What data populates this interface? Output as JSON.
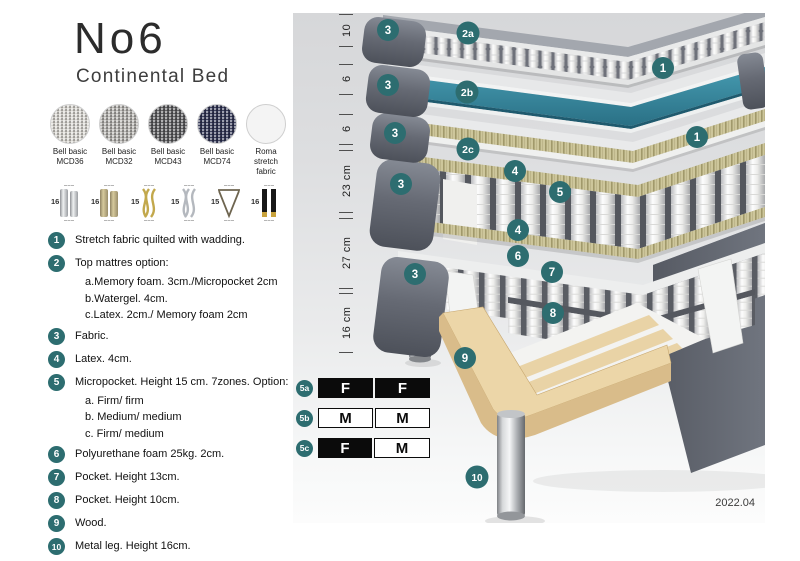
{
  "header": {
    "title": "No6",
    "subtitle": "Continental Bed"
  },
  "fabrics": [
    {
      "line1": "Bell basic",
      "line2": "MCD36"
    },
    {
      "line1": "Bell basic",
      "line2": "MCD32"
    },
    {
      "line1": "Bell basic",
      "line2": "MCD43"
    },
    {
      "line1": "Bell basic",
      "line2": "MCD74"
    },
    {
      "line1": "Roma",
      "line2": "stretch fabric"
    }
  ],
  "legs": [
    {
      "size": "16",
      "type": "cylinder-chrome"
    },
    {
      "size": "16",
      "type": "cylinder-brass"
    },
    {
      "size": "15",
      "type": "twisted-gold"
    },
    {
      "size": "15",
      "type": "twisted-silver"
    },
    {
      "size": "15",
      "type": "hairpin"
    },
    {
      "size": "16",
      "type": "black-gold"
    }
  ],
  "legend": [
    {
      "num": "1",
      "text": "Stretch fabric quilted with wadding."
    },
    {
      "num": "2",
      "text": "Top mattres option:",
      "sub": [
        "a.Memory foam. 3cm./Micropocket 2cm",
        "b.Watergel. 4cm.",
        "c.Latex. 2cm./ Memory foam 2cm"
      ]
    },
    {
      "num": "3",
      "text": "Fabric."
    },
    {
      "num": "4",
      "text": "Latex. 4cm."
    },
    {
      "num": "5",
      "text": "Micropocket. Height 15 cm. 7zones. Option:",
      "sub": [
        "a. Firm/ firm",
        "b. Medium/ medium",
        "c. Firm/ medium"
      ]
    },
    {
      "num": "6",
      "text": "Polyurethane foam 25kg. 2cm."
    },
    {
      "num": "7",
      "text": "Pocket. Height 13cm."
    },
    {
      "num": "8",
      "text": "Pocket. Height 10cm."
    },
    {
      "num": "9",
      "text": "Wood."
    },
    {
      "num": "10",
      "text": "Metal leg. Height 16cm."
    }
  ],
  "ruler": [
    "10",
    "6",
    "6",
    "23 cm",
    "27 cm",
    "16 cm"
  ],
  "badges": {
    "b1": "1",
    "b2a": "2a",
    "b2b": "2b",
    "b2c": "2c",
    "b3": "3",
    "b4": "4",
    "b5": "5",
    "b6": "6",
    "b7": "7",
    "b8": "8",
    "b9": "9",
    "b10": "10"
  },
  "firmness": [
    {
      "id": "5a",
      "cells": [
        {
          "label": "F",
          "style": "dark"
        },
        {
          "label": "F",
          "style": "dark"
        }
      ]
    },
    {
      "id": "5b",
      "cells": [
        {
          "label": "M",
          "style": "light"
        },
        {
          "label": "M",
          "style": "light"
        }
      ]
    },
    {
      "id": "5c",
      "cells": [
        {
          "label": "F",
          "style": "dark"
        },
        {
          "label": "M",
          "style": "light"
        }
      ]
    }
  ],
  "version": "2022.04",
  "colors": {
    "badge_teal": "#2d6d70",
    "watergel_teal": "#35839b",
    "frame_gray": "#62656e",
    "wood_tan": "#e7d0a4"
  }
}
